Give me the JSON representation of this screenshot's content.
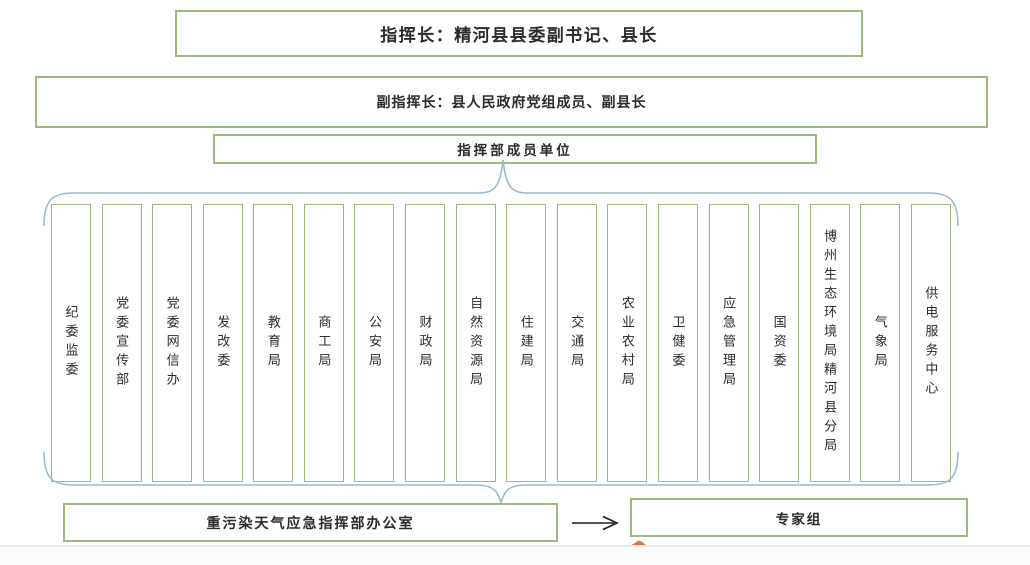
{
  "nodes": {
    "commander": "指挥长：精河县县委副书记、县长",
    "deputy_commander": "副指挥长：县人民政府党组成员、副县长",
    "member_units_header": "指挥部成员单位",
    "office": "重污染天气应急指挥部办公室",
    "expert_group": "专家组"
  },
  "member_units": [
    "纪委监委",
    "党委宣传部",
    "党委网信办",
    "发改委",
    "教育局",
    "商工局",
    "公安局",
    "财政局",
    "自然资源局",
    "住建局",
    "交通局",
    "农业农村局",
    "卫健委",
    "应急管理局",
    "国资委",
    "博州生态环境局精河县分局",
    "气象局",
    "供电服务中心"
  ],
  "icons": {
    "flow_arrow": "right-arrow"
  },
  "colors": {
    "box_border_green": "#9cbb7a",
    "brace_blue": "#96bcd6",
    "text": "#2b2b2b",
    "arrow_black": "#1f1f1f",
    "pen_mark_orange": "#df7549",
    "divider_gray": "#e9e9ed"
  }
}
